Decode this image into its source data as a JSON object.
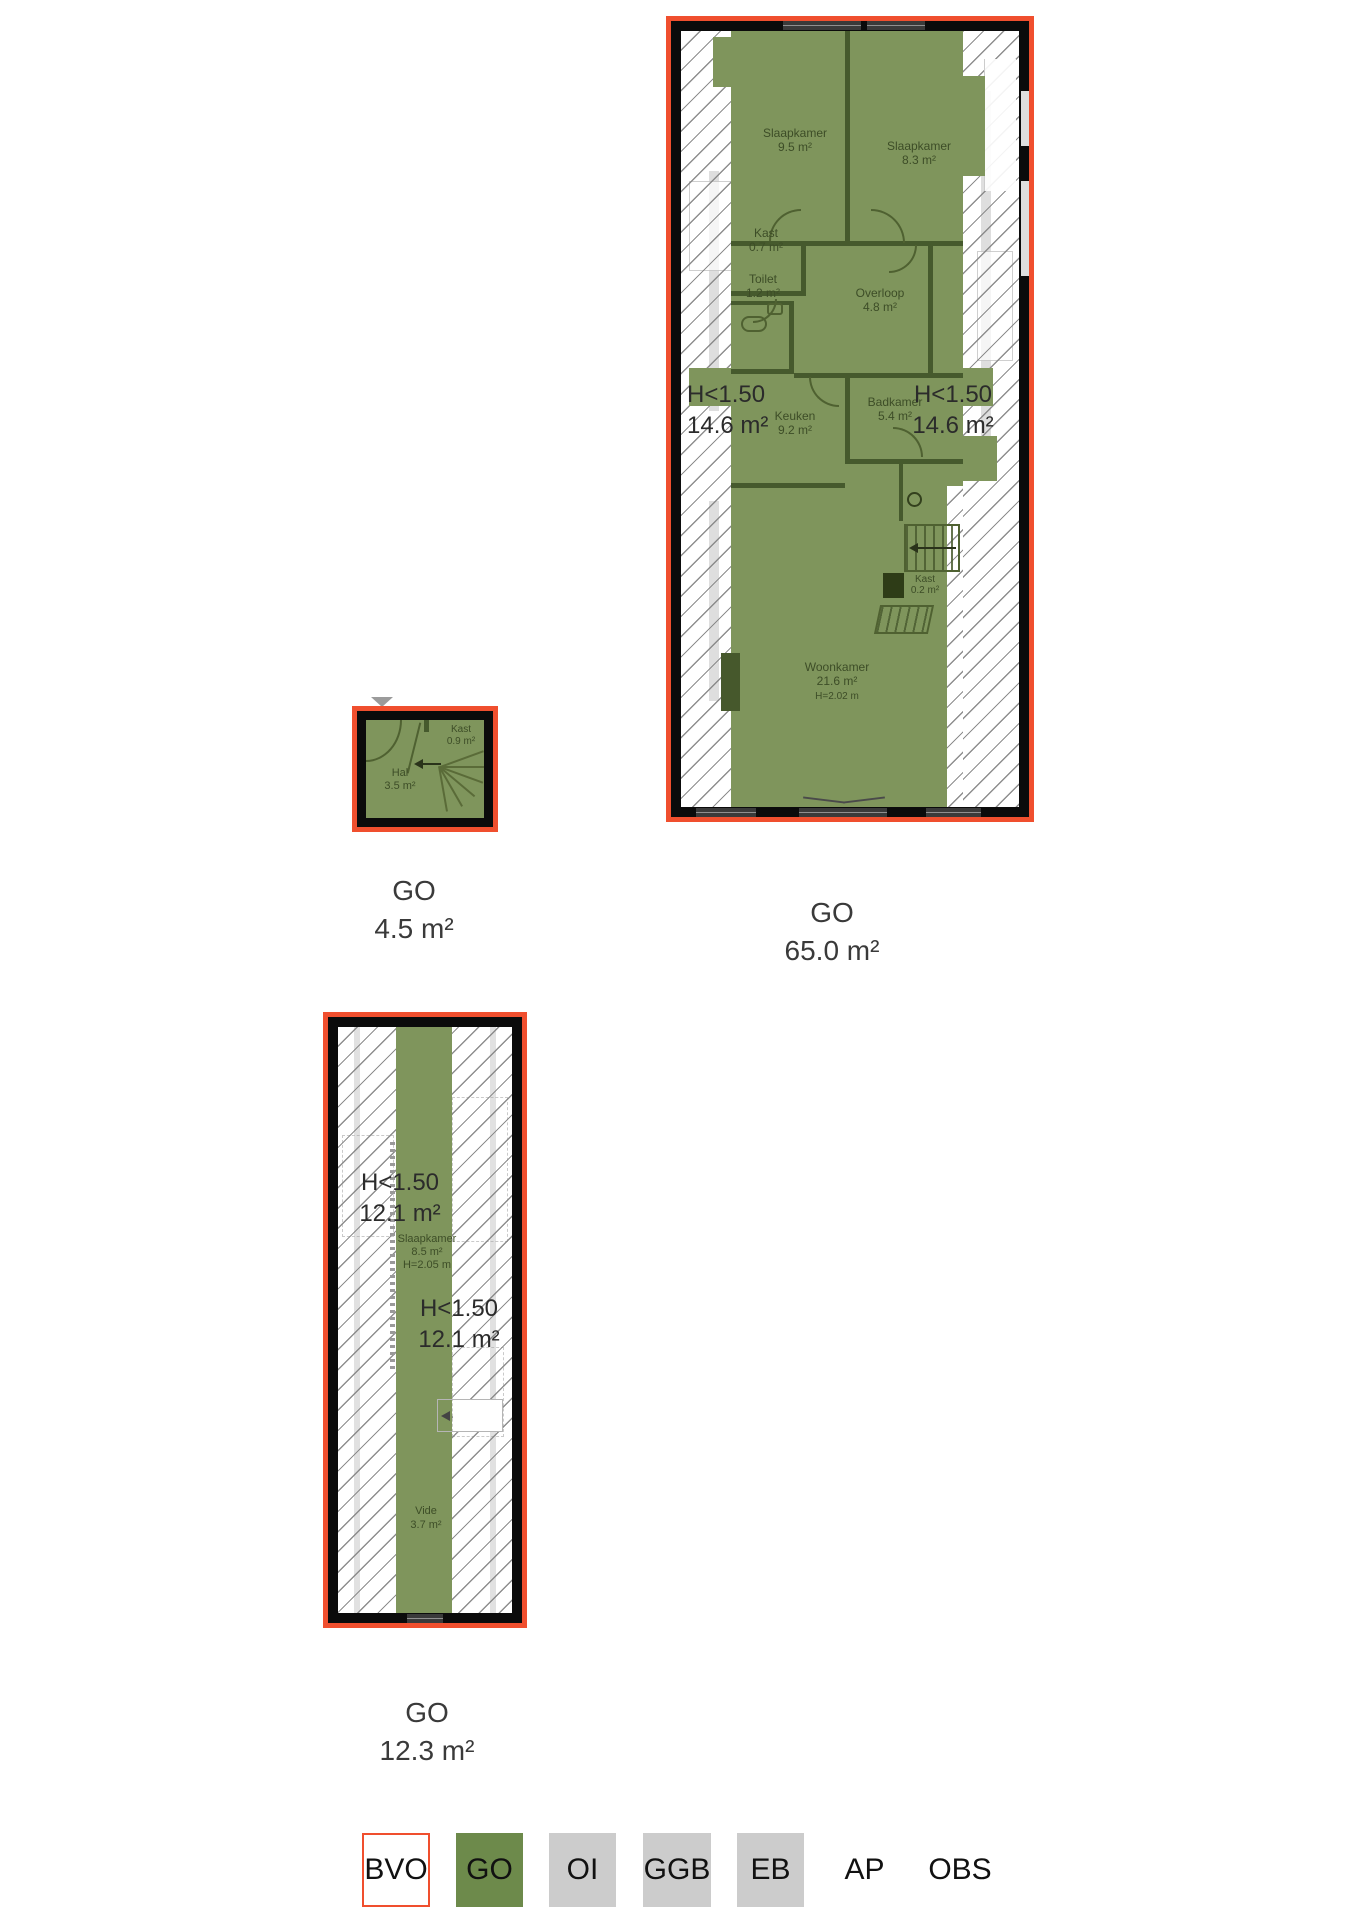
{
  "plans": {
    "plan65": {
      "go": {
        "code": "GO",
        "value": "65.0 m²"
      },
      "h150_left": {
        "l1": "H<1.50",
        "l2": "14.6 m²"
      },
      "h150_right": {
        "l1": "H<1.50",
        "l2": "14.6 m²"
      },
      "rooms": {
        "slaapkamer1": {
          "name": "Slaapkamer",
          "area": "9.5 m²"
        },
        "slaapkamer2": {
          "name": "Slaapkamer",
          "area": "8.3 m²"
        },
        "kast1": {
          "name": "Kast",
          "area": "0.7 m²"
        },
        "toilet": {
          "name": "Toilet",
          "area": "1.2 m²"
        },
        "overloop": {
          "name": "Overloop",
          "area": "4.8 m²"
        },
        "keuken": {
          "name": "Keuken",
          "area": "9.2 m²"
        },
        "badkamer": {
          "name": "Badkamer",
          "area": "5.4 m²"
        },
        "kast2": {
          "name": "Kast",
          "area": "0.2 m²"
        },
        "woonkamer": {
          "name": "Woonkamer",
          "area": "21.6 m²",
          "height": "H=2.02 m"
        }
      }
    },
    "plan45": {
      "go": {
        "code": "GO",
        "value": "4.5 m²"
      },
      "rooms": {
        "hal": {
          "name": "Hal",
          "area": "3.5 m²"
        },
        "kast": {
          "name": "Kast",
          "area": "0.9 m²"
        }
      }
    },
    "plan123": {
      "go": {
        "code": "GO",
        "value": "12.3 m²"
      },
      "h150_left": {
        "l1": "H<1.50",
        "l2": "12.1 m²"
      },
      "h150_right": {
        "l1": "H<1.50",
        "l2": "12.1 m²"
      },
      "rooms": {
        "slaapkamer": {
          "name": "Slaapkamer",
          "area": "8.5 m²",
          "height": "H=2.05 m"
        },
        "vide": {
          "name": "Vide",
          "area": "3.7 m²"
        }
      }
    }
  },
  "legend": {
    "items": [
      {
        "label": "BVO",
        "style": "bvo"
      },
      {
        "label": "GO",
        "style": "green"
      },
      {
        "label": "OI",
        "style": "gray"
      },
      {
        "label": "GGB",
        "style": "gray"
      },
      {
        "label": "EB",
        "style": "gray"
      },
      {
        "label": "AP",
        "style": "plain"
      },
      {
        "label": "OBS",
        "style": "plain"
      }
    ]
  },
  "colors": {
    "outline_red": "#f04f2e",
    "go_green": "#7f955c",
    "legend_green": "#6d8a4b",
    "legend_gray": "#cccccc",
    "wall_black": "#0b0b0b"
  }
}
